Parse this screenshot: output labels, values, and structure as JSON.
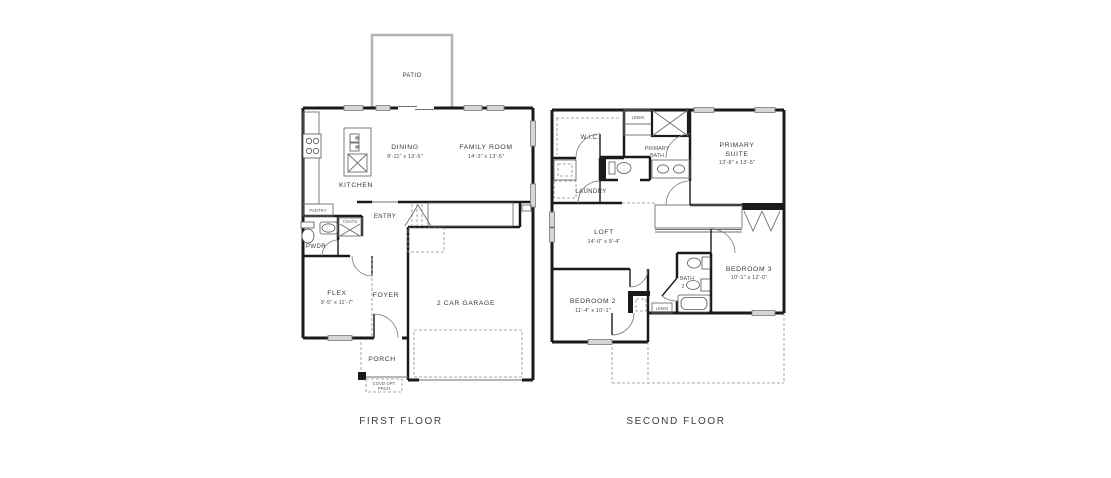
{
  "colors": {
    "background": "#ffffff",
    "wall": "#1a1a1a",
    "window_fill": "#d6d6d6",
    "thin_line": "#6f6f6f",
    "dashed_line": "#8e8e8e",
    "patio_outline": "#b4b4b4",
    "text": "#3a3a3a"
  },
  "first_floor": {
    "title": "FIRST FLOOR",
    "rooms": {
      "patio": "PATIO",
      "dining": "DINING",
      "dining_dims": "9'-11\" x 13'-5\"",
      "family_room": "FAMILY ROOM",
      "family_room_dims": "14'-3\" x 13'-5\"",
      "kitchen": "KITCHEN",
      "pantry": "PANTRY",
      "coats": "COATS",
      "entry": "ENTRY",
      "pwdr": "PWDR",
      "flex": "FLEX",
      "flex_dims": "9'-5\" x 11'-7\"",
      "foyer": "FOYER",
      "garage": "2 CAR GARAGE",
      "porch": "PORCH",
      "note_line1": "COVD OPT",
      "note_line2": "PRCH"
    }
  },
  "second_floor": {
    "title": "SECOND FLOOR",
    "rooms": {
      "wic": "W.I.C.",
      "linen_upper": "LINEN",
      "primary_bath_line1": "PRIMARY",
      "primary_bath_line2": "BATH",
      "primary_suite_line1": "PRIMARY",
      "primary_suite_line2": "SUITE",
      "primary_suite_dims": "13'-8\" x 13'-5\"",
      "laundry": "LAUNDRY",
      "loft": "LOFT",
      "loft_dims": "14'-0\" x 9'-4\"",
      "bedroom2": "BEDROOM 2",
      "bedroom2_dims": "11'-4\" x 10'-1\"",
      "bath2_line1": "BATH",
      "bath2_line2": "2",
      "bedroom3": "BEDROOM 3",
      "bedroom3_dims": "10'-1\" x 12'-0\"",
      "linen_lower": "LINEN"
    }
  }
}
